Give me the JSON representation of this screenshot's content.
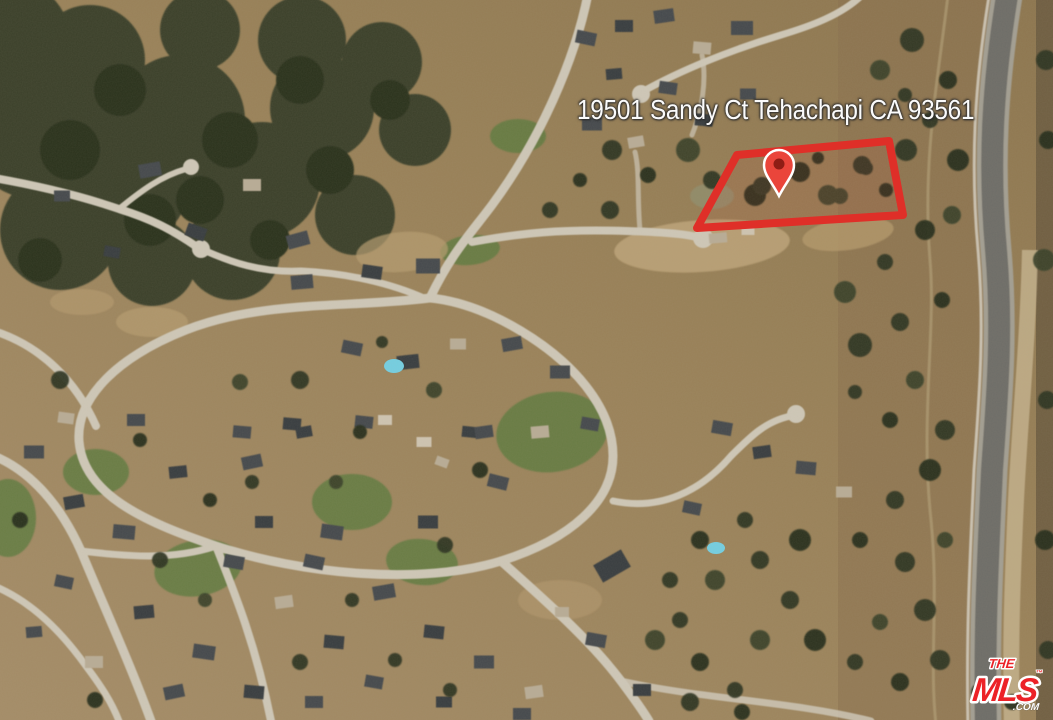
{
  "map": {
    "address_overlay": "19501 Sandy Ct Tehachapi CA 93561",
    "parcel_outline_color": "#df2f28",
    "pin_color": "#ea453b"
  },
  "watermark": {
    "line1": "THE",
    "line2": "MLS",
    "trademark": "™",
    "suffix": ".COM",
    "brand_red": "#ec2227"
  }
}
